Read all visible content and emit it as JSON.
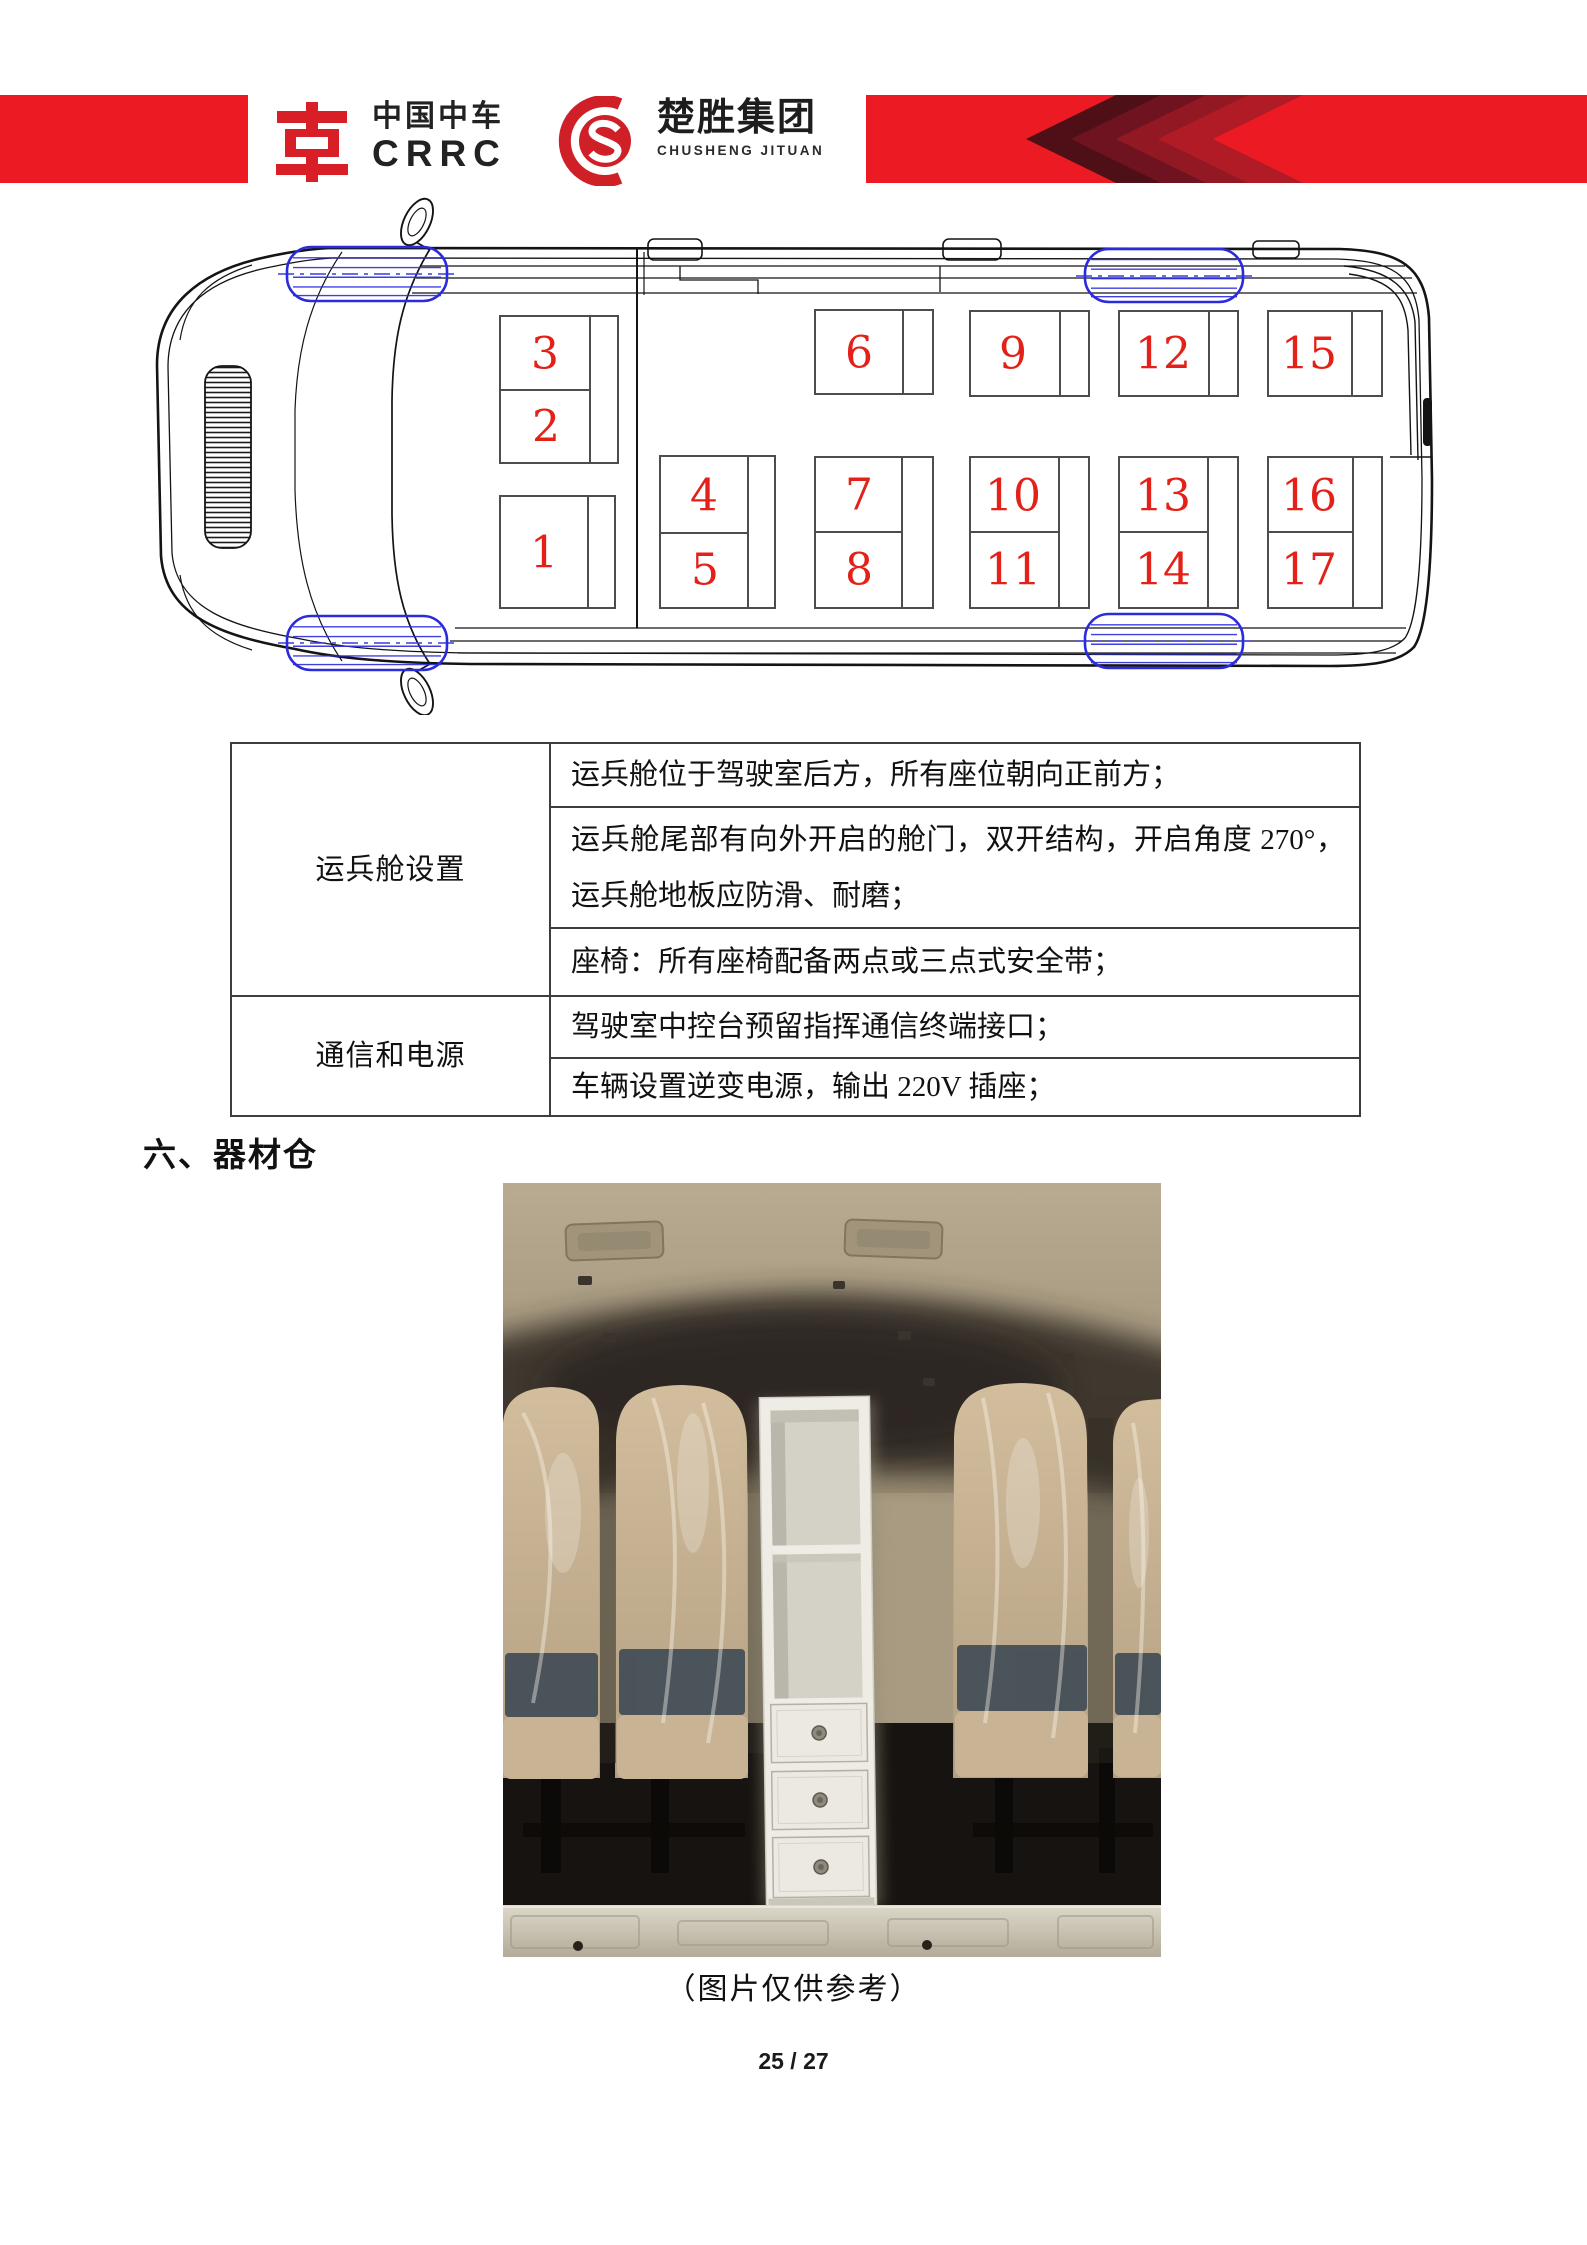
{
  "header": {
    "crrc_cn": "中国中车",
    "crrc_en": "CRRC",
    "chusheng_cn": "楚胜集团",
    "chusheng_en": "CHUSHENG JITUAN",
    "bar_red": "#ec1b23",
    "chevron_shades": [
      "#4f0f16",
      "#701320",
      "#921824",
      "#b01b26"
    ]
  },
  "diagram": {
    "type": "van-top-view-seat-map",
    "seat_count": 17,
    "seat_number_color": "#e32119",
    "line_color": "#141414",
    "seat_outline_color": "#4d4d4d",
    "wheel_color": "#2b2bdd",
    "seat_blocks": [
      {
        "x": 500,
        "y": 316,
        "w": 118,
        "h": 147,
        "split": 390,
        "strip": 590,
        "cells": [
          {
            "n": "3",
            "cx": 545,
            "cy": 354
          },
          {
            "n": "2",
            "cx": 546,
            "cy": 427
          }
        ]
      },
      {
        "x": 500,
        "y": 496,
        "w": 115,
        "h": 112,
        "strip": 588,
        "cells": [
          {
            "n": "1",
            "cx": 544,
            "cy": 553
          }
        ]
      },
      {
        "x": 660,
        "y": 456,
        "w": 115,
        "h": 152,
        "split": 533,
        "strip": 748,
        "cells": [
          {
            "n": "4",
            "cx": 704,
            "cy": 496
          },
          {
            "n": "5",
            "cx": 705,
            "cy": 570
          }
        ]
      },
      {
        "x": 815,
        "y": 310,
        "w": 118,
        "h": 84,
        "strip": 903,
        "cells": [
          {
            "n": "6",
            "cx": 859,
            "cy": 353
          }
        ]
      },
      {
        "x": 815,
        "y": 457,
        "w": 118,
        "h": 151,
        "split": 532,
        "strip": 902,
        "cells": [
          {
            "n": "7",
            "cx": 859,
            "cy": 495
          },
          {
            "n": "8",
            "cx": 859,
            "cy": 570
          }
        ]
      },
      {
        "x": 970,
        "y": 311,
        "w": 119,
        "h": 85,
        "strip": 1060,
        "cells": [
          {
            "n": "9",
            "cx": 1013,
            "cy": 354
          }
        ]
      },
      {
        "x": 970,
        "y": 457,
        "w": 119,
        "h": 151,
        "split": 532,
        "strip": 1059,
        "cells": [
          {
            "n": "10",
            "cx": 1013,
            "cy": 496
          },
          {
            "n": "11",
            "cx": 1013,
            "cy": 570
          }
        ]
      },
      {
        "x": 1119,
        "y": 311,
        "w": 119,
        "h": 85,
        "strip": 1209,
        "cells": [
          {
            "n": "12",
            "cx": 1163,
            "cy": 354
          }
        ]
      },
      {
        "x": 1119,
        "y": 457,
        "w": 119,
        "h": 151,
        "split": 532,
        "strip": 1208,
        "cells": [
          {
            "n": "13",
            "cx": 1163,
            "cy": 496
          },
          {
            "n": "14",
            "cx": 1163,
            "cy": 570
          }
        ]
      },
      {
        "x": 1268,
        "y": 311,
        "w": 114,
        "h": 85,
        "strip": 1352,
        "cells": [
          {
            "n": "15",
            "cx": 1309,
            "cy": 354
          }
        ]
      },
      {
        "x": 1268,
        "y": 457,
        "w": 114,
        "h": 151,
        "split": 532,
        "strip": 1353,
        "cells": [
          {
            "n": "16",
            "cx": 1309,
            "cy": 496
          },
          {
            "n": "17",
            "cx": 1309,
            "cy": 570
          }
        ]
      }
    ],
    "wheels": [
      {
        "x": 287,
        "y": 247,
        "w": 160,
        "h": 54
      },
      {
        "x": 1085,
        "y": 249,
        "w": 158,
        "h": 53
      },
      {
        "x": 287,
        "y": 616,
        "w": 160,
        "h": 54
      },
      {
        "x": 1085,
        "y": 614,
        "w": 158,
        "h": 54
      }
    ]
  },
  "table": {
    "groups": [
      {
        "label": "运兵舱设置",
        "items": [
          "运兵舱位于驾驶室后方，所有座位朝向正前方；",
          "运兵舱尾部有向外开启的舱门，双开结构，开启角度 270°，运兵舱地板应防滑、耐磨；",
          "座椅：所有座椅配备两点或三点式安全带；"
        ]
      },
      {
        "label": "通信和电源",
        "items": [
          "驾驶室中控台预留指挥通信终端接口；",
          "车辆设置逆变电源，输出 220V 插座；"
        ]
      }
    ]
  },
  "section": {
    "heading": "六、器材仓"
  },
  "photo": {
    "caption": "（图片仅供参考）"
  },
  "footer": {
    "page_number": "25 / 27"
  }
}
